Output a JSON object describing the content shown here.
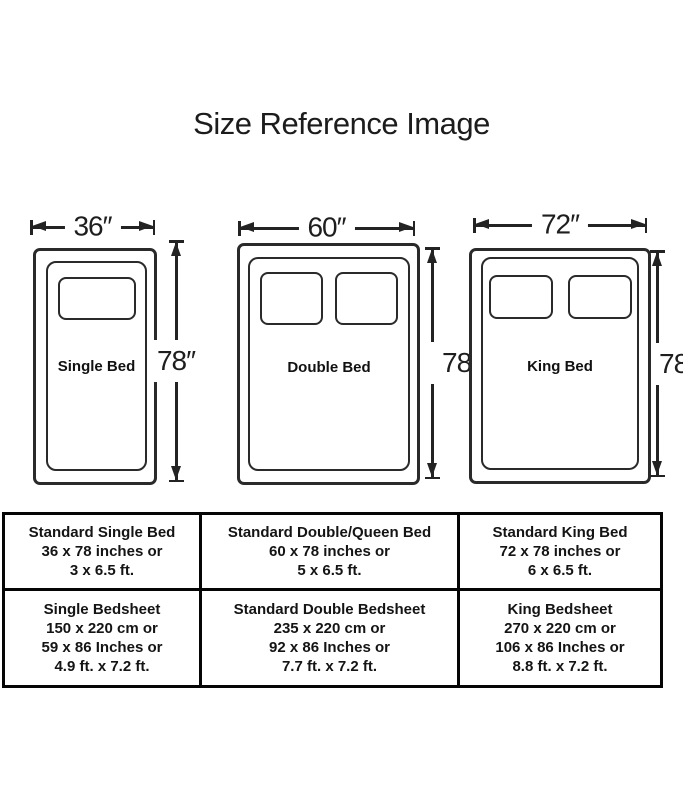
{
  "title": "Size Reference Image",
  "colors": {
    "line": "#2a2a2a",
    "table_border": "#050505",
    "text": "#141414",
    "background": "#ffffff"
  },
  "beds": [
    {
      "name": "Single Bed",
      "width_label": "36″",
      "height_label": "78″",
      "pillow_count": 1
    },
    {
      "name": "Double Bed",
      "width_label": "60″",
      "height_label": "78″",
      "pillow_count": 2
    },
    {
      "name": "King Bed",
      "width_label": "72″",
      "height_label": "78″",
      "pillow_count": 2
    }
  ],
  "table": {
    "rows": [
      {
        "cells": [
          {
            "lines": [
              "Standard Single Bed",
              "36 x 78 inches or",
              "3 x 6.5 ft."
            ]
          },
          {
            "lines": [
              "Standard Double/Queen Bed",
              "60 x 78 inches or",
              "5 x 6.5 ft."
            ]
          },
          {
            "lines": [
              "Standard King Bed",
              "72 x 78 inches or",
              "6 x 6.5 ft."
            ]
          }
        ]
      },
      {
        "cells": [
          {
            "lines": [
              "Single Bedsheet",
              "150 x 220 cm or",
              "59 x 86 Inches or",
              "4.9 ft. x 7.2 ft."
            ]
          },
          {
            "lines": [
              "Standard Double Bedsheet",
              "235 x 220 cm or",
              "92 x 86 Inches or",
              "7.7 ft. x 7.2 ft."
            ]
          },
          {
            "lines": [
              "King Bedsheet",
              "270 x 220 cm or",
              "106 x 86 Inches or",
              "8.8 ft. x 7.2 ft."
            ]
          }
        ]
      }
    ]
  }
}
